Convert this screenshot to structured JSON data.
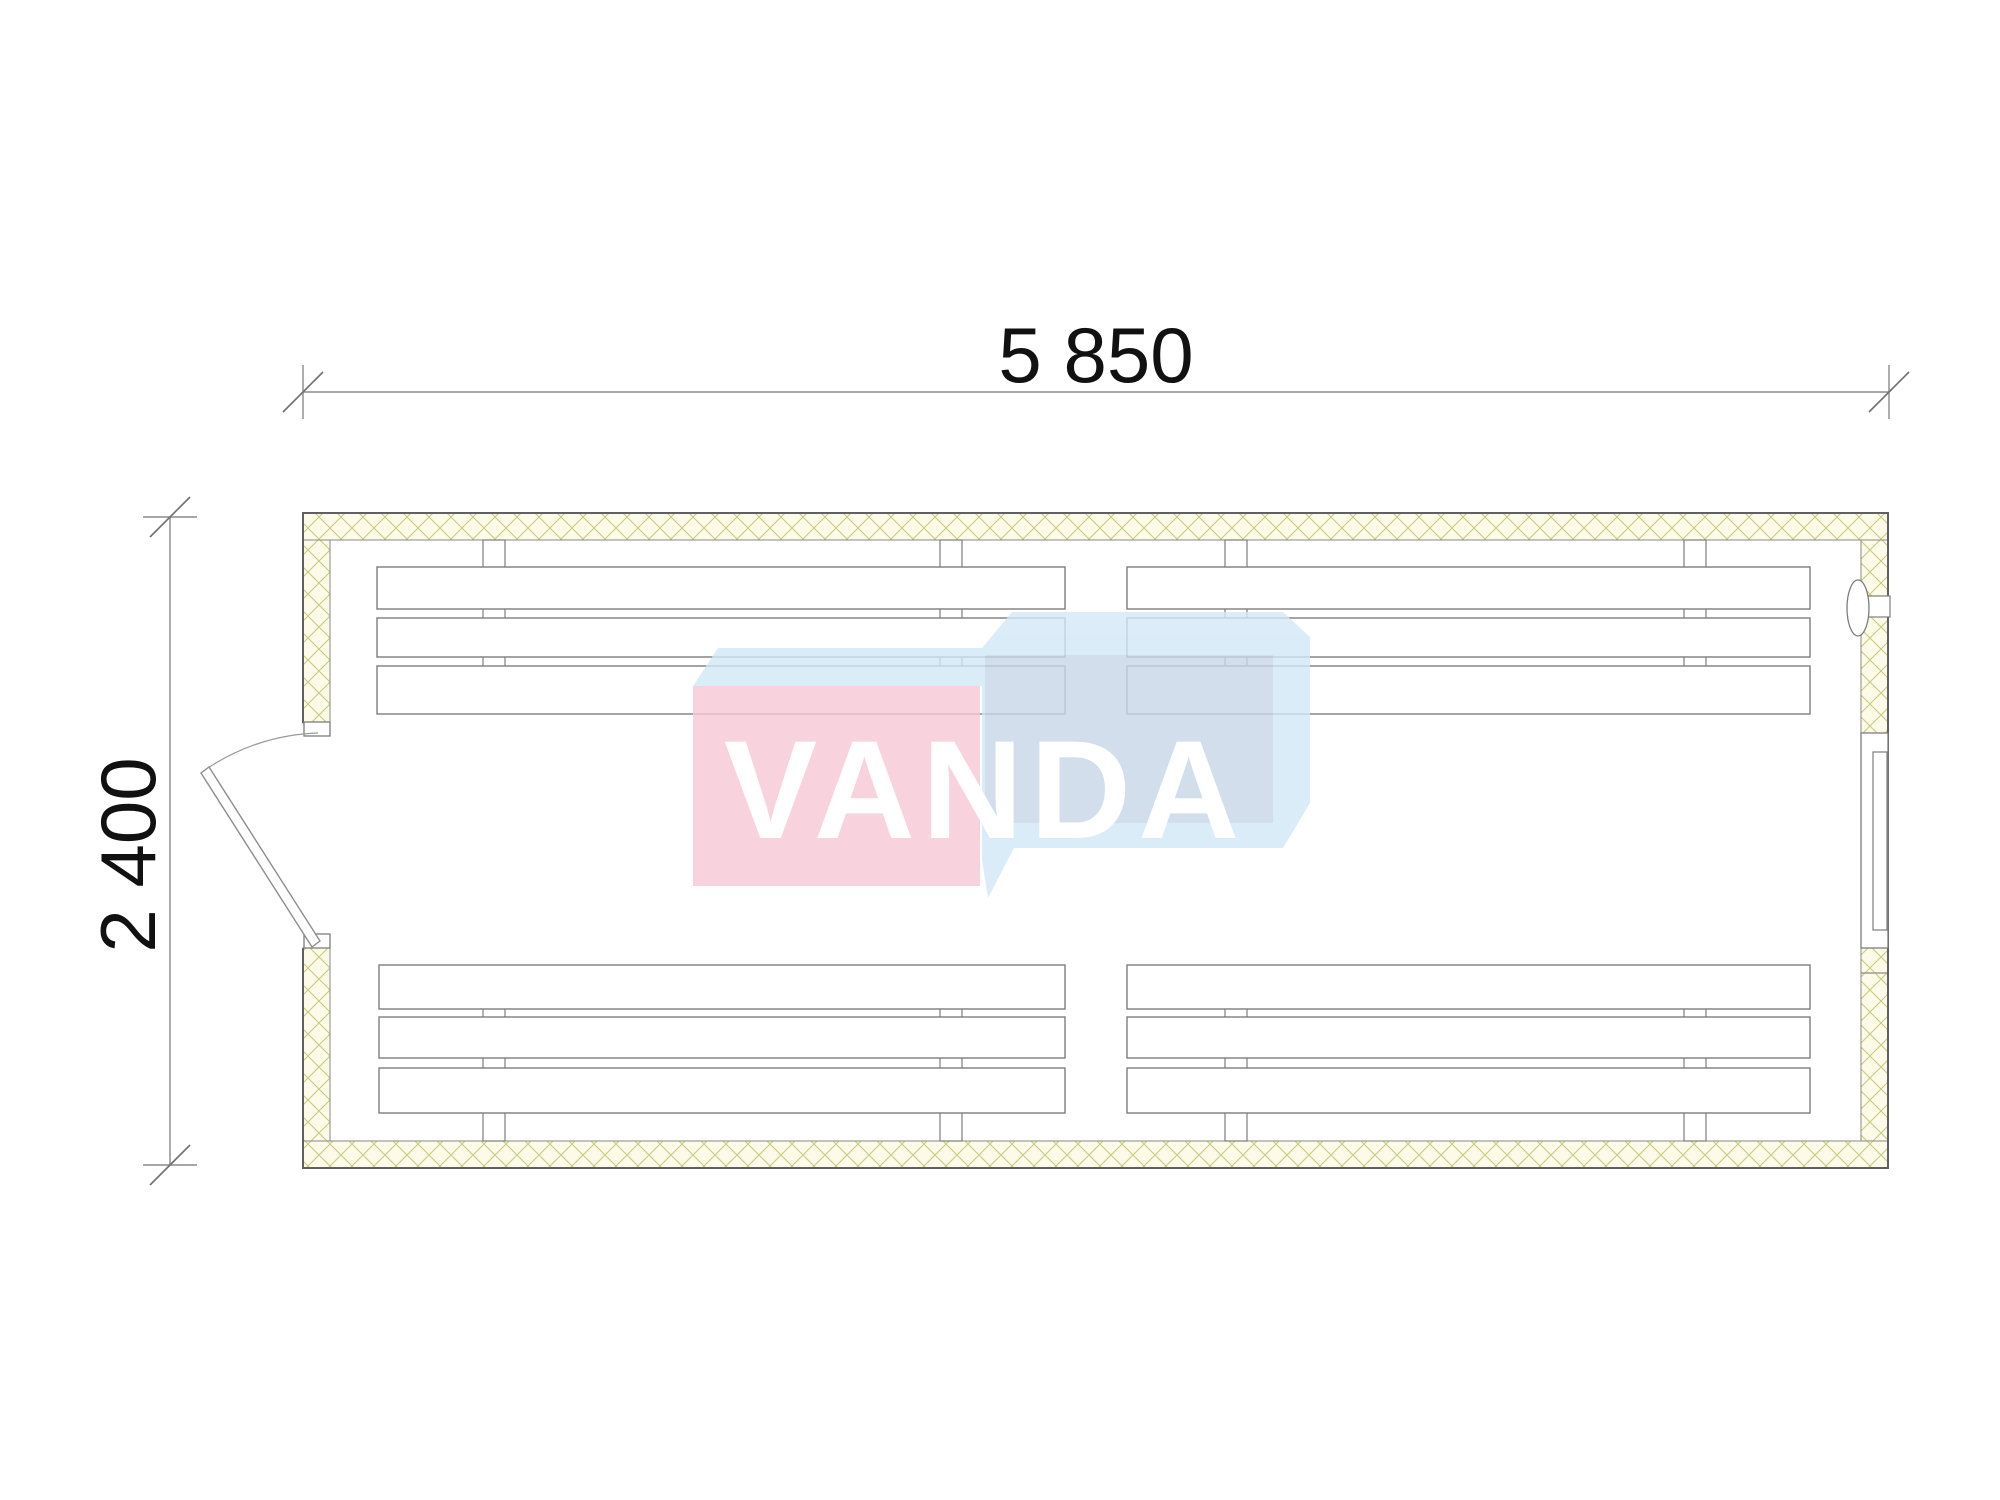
{
  "dimensions": {
    "width_label": "5 850",
    "height_label": "2 400"
  },
  "watermark": {
    "text": "VANDA"
  },
  "colors": {
    "wall_fill": "#fbfbe7",
    "hatch_line": "#c8c87c",
    "outer_outline": "#606060",
    "drawing_line": "#7d7d7d",
    "dim_line": "#8a8a8a",
    "dim_text": "#111111",
    "logo_pink": "#f7c9d5",
    "logo_blue_light": "#d3e8f8",
    "logo_blue_gray": "#c8d7e7",
    "logo_text": "#ffffff"
  }
}
